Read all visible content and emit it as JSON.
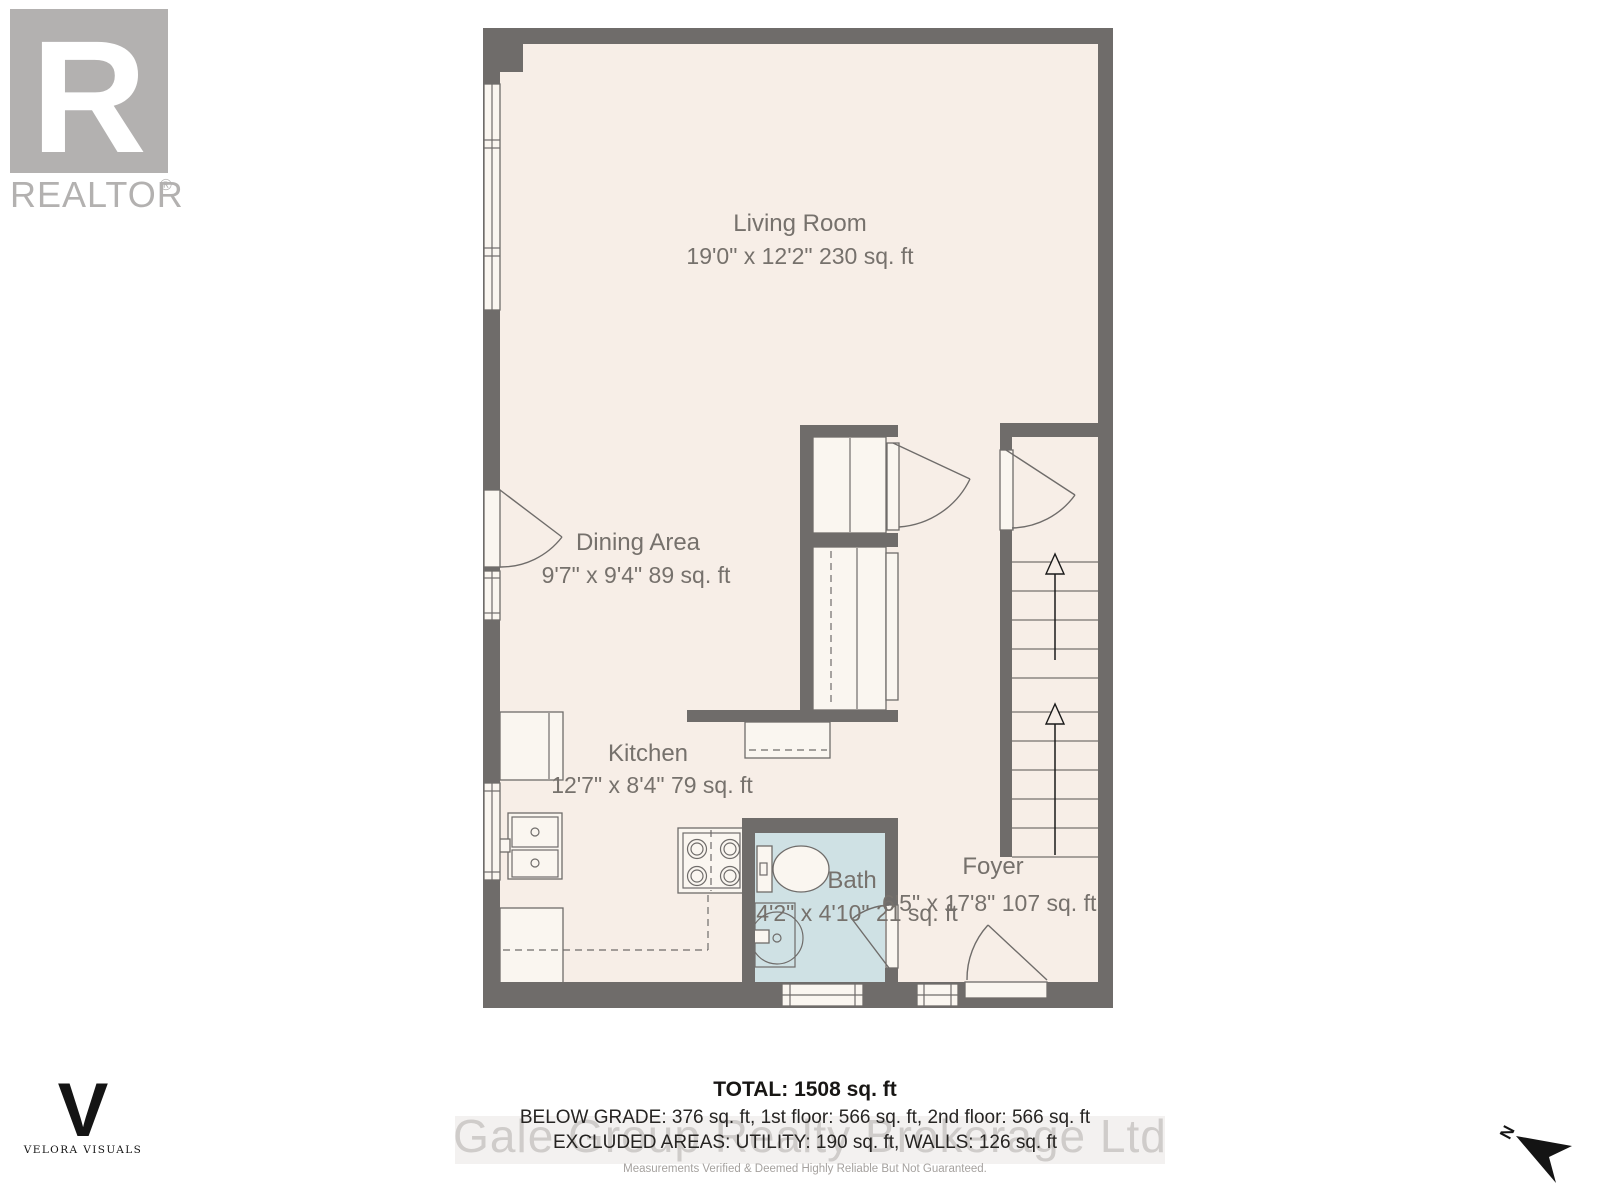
{
  "branding": {
    "realtor_letter": "R",
    "realtor_name": "REALTOR",
    "registered": "®",
    "photographer_letter": "V",
    "photographer_name": "VELORA VISUALS"
  },
  "floor_plan": {
    "rooms": [
      {
        "name": "Living Room",
        "dimensions": "19'0\" x 12'2\" 230 sq. ft"
      },
      {
        "name": "Dining Area",
        "dimensions": "9'7\" x 9'4\" 89 sq. ft"
      },
      {
        "name": "Kitchen",
        "dimensions": "12'7\" x 8'4\" 79 sq. ft"
      },
      {
        "name": "Bath",
        "dimensions": "4'2\" x 4'10\" 21 sq. ft"
      },
      {
        "name": "Foyer",
        "dimensions": "6'5\" x 17'8\" 107 sq. ft"
      }
    ],
    "north_label": "N"
  },
  "summary": {
    "total": "TOTAL: 1508 sq. ft",
    "breakdown": "BELOW GRADE: 376 sq. ft, 1st floor: 566 sq. ft, 2nd floor: 566 sq. ft",
    "excluded": "EXCLUDED AREAS: UTILITY: 190 sq. ft, WALLS: 126 sq. ft"
  },
  "watermark": {
    "text": "Gale Group Realty Brokerage Ltd"
  },
  "disclaimer": {
    "text": "Measurements Verified & Deemed Highly Reliable But Not Guaranteed."
  },
  "colors": {
    "wall": "#6f6c6a",
    "floor": "#f7eee7",
    "bath_floor": "#cfe1e4",
    "fixture": "#faf6f0",
    "label_text": "#76716c",
    "watermark": "#c9c6c4",
    "logo_gray": "#b3b1b0"
  }
}
